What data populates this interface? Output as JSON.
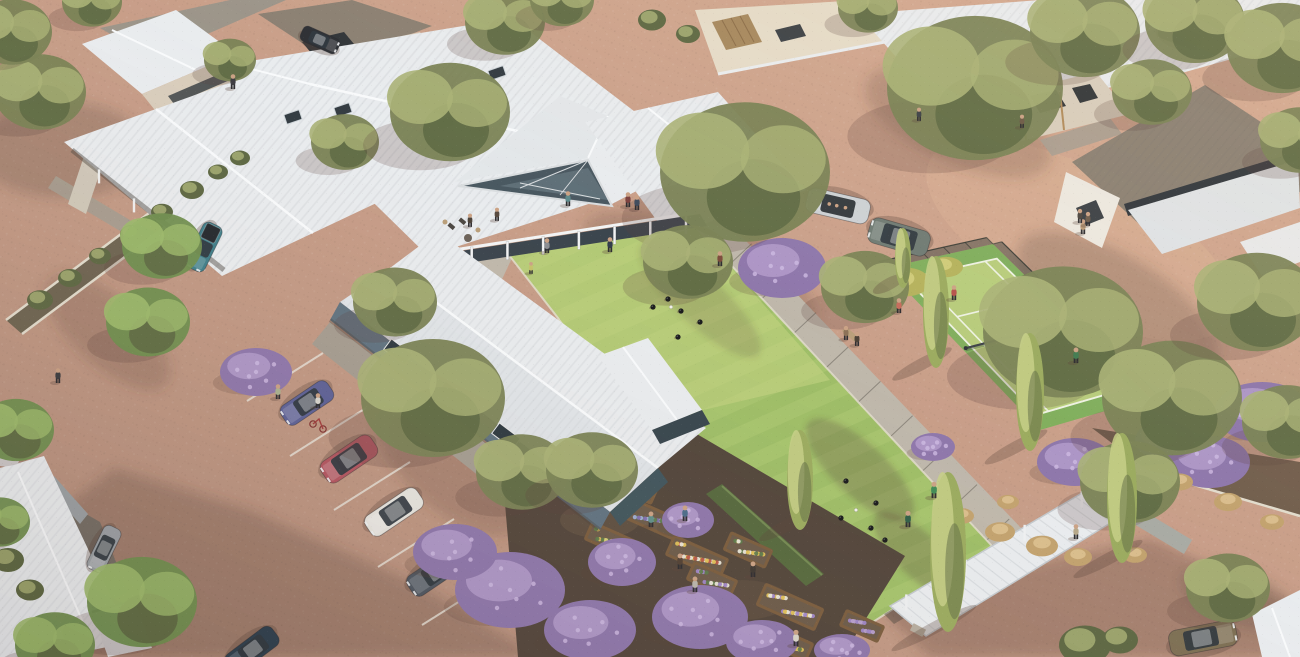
{
  "meta": {
    "title": "Aerial architectural render of a retirement village: central clubhouse with white metal roofs and glass gable, lawn bowls green with players, tennis court, raised community garden beds with purple flowering shrubs, gravel roads and car park with cars, surrounded by single-storey homes and eucalyptus trees",
    "width": 1300,
    "height": 657
  },
  "palette": {
    "gravel": "#c89e89",
    "gravelLight": "#dcb49a",
    "gravelShadow": "#8a695d",
    "roofWhite": "#e9ecef",
    "roofShade": "#d4d9dd",
    "roofRidge": "#f8fafc",
    "roofGrey": "#9b9489",
    "roofTaupe": "#8a7f72",
    "wallBeige": "#d8cdbc",
    "wallCream": "#e5dbc8",
    "wallWhite": "#ece8e0",
    "wallBlueGrey": "#5f7280",
    "wallTeal": "#3f545c",
    "glassDark": "#2e363e",
    "glassBlue": "#47565f",
    "concrete": "#beb7ab",
    "concreteShade": "#a49c90",
    "curb": "#e2dccd",
    "lawn": "#9dbd66",
    "lawnLight": "#c3d382",
    "lawnShade": "#7da04f",
    "courtOuter": "#7fae5c",
    "courtInner": "#b7cc7b",
    "lineWhite": "#eef2e3",
    "hedge": "#55683d",
    "treeGreen": "#7a8255",
    "treeLight": "#a9b176",
    "treeDark": "#5c6742",
    "treeBright": "#6f8f4f",
    "treeBrightLight": "#9cba6c",
    "poplar": "#9aaa5e",
    "poplarLight": "#c6cf86",
    "shrubPurple": "#8d76ab",
    "shrubPurpleLight": "#b7a0cf",
    "mulch": "#51443a",
    "soil": "#6b5a49",
    "wood": "#7a5c3d",
    "flowerYellow": "#e2c258",
    "flowerWhite": "#ebe8da",
    "flowerRed": "#bb5747",
    "yellowShrub": "#b5b25c",
    "grassTan": "#c2a26e",
    "shadow": "#594239",
    "skin": "#caa184"
  },
  "legend": {
    "areas": [
      "clubhouse",
      "bowls-green",
      "tennis-court",
      "community-garden",
      "car-park",
      "pergola-walkway",
      "village-homes",
      "gravel-roads"
    ]
  },
  "scene": {
    "skylights": [
      [
        293,
        117
      ],
      [
        343,
        110
      ],
      [
        445,
        123
      ],
      [
        478,
        133
      ],
      [
        537,
        130
      ],
      [
        497,
        73
      ]
    ],
    "parking_lines": [
      [
        323,
        353,
        247,
        401
      ],
      [
        366,
        408,
        290,
        456
      ],
      [
        410,
        462,
        334,
        510
      ],
      [
        454,
        519,
        378,
        567
      ],
      [
        498,
        577,
        422,
        625
      ]
    ],
    "cars": [
      {
        "n": "teal-pickup",
        "x": 204,
        "y": 247,
        "a": 116,
        "l": 50,
        "w": 21,
        "c": "#3f7e8a",
        "t": "pickup"
      },
      {
        "n": "blue-coupe",
        "x": 307,
        "y": 403,
        "a": 146,
        "l": 56,
        "w": 23,
        "c": "#5c6096",
        "t": "sedan"
      },
      {
        "n": "red-suv",
        "x": 349,
        "y": 459,
        "a": 146,
        "l": 60,
        "w": 25,
        "c": "#b25560",
        "t": "suv"
      },
      {
        "n": "white-sedan",
        "x": 394,
        "y": 512,
        "a": 146,
        "l": 62,
        "w": 24,
        "c": "#e6e4df",
        "t": "sedan"
      },
      {
        "n": "grey-sedan",
        "x": 436,
        "y": 572,
        "a": 146,
        "l": 62,
        "w": 24,
        "c": "#4d5560",
        "t": "sedan"
      },
      {
        "n": "dark-sedan-edge",
        "x": 252,
        "y": 650,
        "a": 143,
        "l": 58,
        "w": 23,
        "c": "#2c3e4e",
        "t": "sedan"
      },
      {
        "n": "silver-convertible",
        "x": 838,
        "y": 206,
        "a": 193,
        "l": 64,
        "w": 25,
        "c": "#ccd1d5",
        "t": "open"
      },
      {
        "n": "sage-suv",
        "x": 899,
        "y": 237,
        "a": 196,
        "l": 62,
        "w": 26,
        "c": "#6e7a73",
        "t": "suv"
      },
      {
        "n": "bronze-classic",
        "x": 1203,
        "y": 638,
        "a": -11,
        "l": 68,
        "w": 26,
        "c": "#7c6e53",
        "t": "sedan"
      },
      {
        "n": "garage-car-nw",
        "x": 320,
        "y": 40,
        "a": 24,
        "l": 40,
        "w": 16,
        "c": "#2b2e33",
        "t": "sedan"
      },
      {
        "n": "carport-car-ne",
        "x": 1180,
        "y": 36,
        "a": 20,
        "l": 44,
        "w": 17,
        "c": "#35383c",
        "t": "suv"
      },
      {
        "n": "carport-car-sw",
        "x": 104,
        "y": 549,
        "a": 116,
        "l": 48,
        "w": 19,
        "c": "#9aa0a5",
        "t": "sedan"
      }
    ],
    "trees": [
      [
        40,
        92,
        46,
        0
      ],
      [
        12,
        32,
        40,
        0
      ],
      [
        92,
        2,
        30,
        0
      ],
      [
        230,
        60,
        26,
        0
      ],
      [
        345,
        142,
        34,
        0
      ],
      [
        162,
        246,
        40,
        1
      ],
      [
        148,
        322,
        42,
        1
      ],
      [
        450,
        112,
        60,
        0
      ],
      [
        505,
        22,
        40,
        0
      ],
      [
        562,
        0,
        32,
        0
      ],
      [
        868,
        8,
        30,
        0
      ],
      [
        745,
        172,
        85,
        0
      ],
      [
        688,
        262,
        45,
        0
      ],
      [
        975,
        88,
        88,
        0
      ],
      [
        1085,
        32,
        55,
        0
      ],
      [
        1195,
        22,
        50,
        0
      ],
      [
        1282,
        48,
        55,
        0
      ],
      [
        1152,
        92,
        40,
        0
      ],
      [
        1300,
        140,
        40,
        0
      ],
      [
        433,
        398,
        72,
        0
      ],
      [
        395,
        302,
        42,
        0
      ],
      [
        522,
        472,
        46,
        0
      ],
      [
        592,
        470,
        46,
        0
      ],
      [
        142,
        602,
        55,
        1
      ],
      [
        55,
        645,
        40,
        1
      ],
      [
        16,
        430,
        38,
        1
      ],
      [
        0,
        522,
        30,
        1
      ],
      [
        1063,
        332,
        80,
        0
      ],
      [
        1172,
        398,
        70,
        0
      ],
      [
        1257,
        302,
        60,
        0
      ],
      [
        1287,
        422,
        45,
        0
      ],
      [
        1130,
        482,
        50,
        0
      ],
      [
        865,
        287,
        44,
        0
      ],
      [
        1228,
        588,
        42,
        0
      ]
    ],
    "poplars": [
      [
        936,
        312,
        112,
        26
      ],
      [
        1030,
        392,
        118,
        28
      ],
      [
        800,
        480,
        100,
        26
      ],
      [
        948,
        552,
        160,
        36
      ],
      [
        1122,
        498,
        130,
        30
      ],
      [
        903,
        258,
        60,
        16
      ]
    ],
    "shrubs": {
      "purple": [
        [
          256,
          372,
          36,
          24
        ],
        [
          782,
          268,
          44,
          30
        ],
        [
          1262,
          412,
          48,
          30
        ],
        [
          1210,
          462,
          40,
          26
        ],
        [
          1165,
          440,
          30,
          20
        ],
        [
          510,
          590,
          55,
          38
        ],
        [
          455,
          552,
          42,
          28
        ],
        [
          590,
          630,
          46,
          30
        ],
        [
          700,
          617,
          48,
          32
        ],
        [
          622,
          562,
          34,
          24
        ],
        [
          762,
          642,
          36,
          22
        ],
        [
          842,
          650,
          28,
          16
        ],
        [
          1075,
          462,
          38,
          24
        ],
        [
          933,
          447,
          22,
          14
        ],
        [
          688,
          520,
          26,
          18
        ]
      ],
      "green": [
        [
          40,
          300,
          13
        ],
        [
          70,
          278,
          12
        ],
        [
          100,
          256,
          11
        ],
        [
          132,
          234,
          12
        ],
        [
          162,
          212,
          11
        ],
        [
          192,
          190,
          12
        ],
        [
          218,
          172,
          10
        ],
        [
          240,
          158,
          10
        ],
        [
          652,
          20,
          14
        ],
        [
          688,
          34,
          12
        ],
        [
          8,
          560,
          16
        ],
        [
          30,
          590,
          14
        ],
        [
          1085,
          645,
          26
        ],
        [
          1120,
          640,
          18
        ]
      ],
      "yellow": [
        [
          906,
          282,
          24
        ],
        [
          946,
          267,
          17
        ]
      ],
      "grass": [
        [
          1000,
          532,
          15
        ],
        [
          1042,
          546,
          16
        ],
        [
          1078,
          557,
          14
        ],
        [
          962,
          516,
          12
        ],
        [
          1008,
          502,
          11
        ],
        [
          1180,
          482,
          13
        ],
        [
          1228,
          502,
          14
        ],
        [
          1272,
          522,
          12
        ],
        [
          1135,
          555,
          12
        ]
      ]
    },
    "planters": [
      {
        "x": 655,
        "y": 520,
        "a": 24,
        "l": 52,
        "w": 20,
        "colors": [
          "#7f6fb2",
          "#9fb0d8",
          "#5d7a4a"
        ]
      },
      {
        "x": 610,
        "y": 540,
        "a": 24,
        "l": 46,
        "w": 18,
        "colors": [
          "#e2c258",
          "#d8d07a",
          "#5d7a4a"
        ]
      },
      {
        "x": 697,
        "y": 557,
        "a": 24,
        "l": 58,
        "w": 20,
        "colors": [
          "#e2c258",
          "#bb5747",
          "#ebe8da"
        ]
      },
      {
        "x": 748,
        "y": 550,
        "a": 24,
        "l": 44,
        "w": 18,
        "colors": [
          "#e2c258",
          "#ebe8da",
          "#5d7a4a"
        ]
      },
      {
        "x": 712,
        "y": 580,
        "a": 24,
        "l": 46,
        "w": 18,
        "colors": [
          "#9f86c9",
          "#ebe8da",
          "#5d7a4a"
        ]
      },
      {
        "x": 790,
        "y": 607,
        "a": 24,
        "l": 62,
        "w": 22,
        "colors": [
          "#9f86c9",
          "#e2c258",
          "#ebe8da"
        ]
      },
      {
        "x": 788,
        "y": 643,
        "a": 24,
        "l": 46,
        "w": 18,
        "colors": [
          "#e2c258",
          "#d0c870",
          "#5d7a4a"
        ]
      },
      {
        "x": 862,
        "y": 626,
        "a": 24,
        "l": 40,
        "w": 16,
        "colors": [
          "#9f86c9",
          "#b7a0cf"
        ]
      },
      {
        "x": 638,
        "y": 490,
        "a": 24,
        "l": 34,
        "w": 14,
        "colors": [
          "#7f6fb2",
          "#9fb0d8"
        ]
      }
    ],
    "people": [
      [
        58,
        382,
        "#3a3a3f",
        1
      ],
      [
        233,
        88,
        "#3b3b40",
        1
      ],
      [
        278,
        398,
        "#a9b18f",
        1
      ],
      [
        318,
        407,
        "#d8d6cf",
        1
      ],
      [
        568,
        205,
        "#5d8a8c",
        1
      ],
      [
        628,
        206,
        "#7a3f3d",
        1
      ],
      [
        637,
        209,
        "#3d4a5c",
        1
      ],
      [
        547,
        252,
        "#8a8d92",
        1
      ],
      [
        610,
        251,
        "#2f3a4a",
        1
      ],
      [
        531,
        273,
        "#c3c36a",
        0.8
      ],
      [
        470,
        226,
        "#4a4038",
        0.9
      ],
      [
        497,
        220,
        "#55483e",
        0.9
      ],
      [
        720,
        265,
        "#7a4a3a",
        1
      ],
      [
        846,
        339,
        "#8a6f55",
        0.95
      ],
      [
        857,
        345,
        "#4a3f35",
        0.95
      ],
      [
        934,
        497,
        "#3f8a55",
        1.1
      ],
      [
        908,
        526,
        "#2e5d46",
        1.1
      ],
      [
        899,
        312,
        "#c56a5a",
        1
      ],
      [
        954,
        299,
        "#b5504a",
        1
      ],
      [
        1076,
        362,
        "#3f7a4f",
        1.05
      ],
      [
        1083,
        233,
        "#b99a77",
        1
      ],
      [
        919,
        120,
        "#3a3f44",
        0.9
      ],
      [
        1022,
        127,
        "#6a5744",
        0.9
      ],
      [
        1080,
        222,
        "#4a443e",
        0.95
      ],
      [
        1088,
        225,
        "#6b5a4a",
        0.95
      ],
      [
        651,
        526,
        "#5f8f8a",
        1.05
      ],
      [
        685,
        520,
        "#4a6b8a",
        1.05
      ],
      [
        680,
        568,
        "#4f3f33",
        1.05
      ],
      [
        695,
        591,
        "#b9b5ac",
        1.05
      ],
      [
        753,
        576,
        "#3c3630",
        1.05
      ],
      [
        796,
        645,
        "#d9d5c9",
        1.1
      ],
      [
        1076,
        538,
        "#b5a688",
        1
      ]
    ],
    "bowls": {
      "black": [
        [
          653,
          307
        ],
        [
          668,
          299
        ],
        [
          681,
          311
        ],
        [
          700,
          322
        ],
        [
          678,
          337
        ],
        [
          876,
          503
        ],
        [
          871,
          528
        ],
        [
          846,
          481
        ],
        [
          841,
          518
        ],
        [
          885,
          540
        ]
      ],
      "jack": [
        [
          671,
          307
        ],
        [
          856,
          510
        ]
      ]
    }
  }
}
